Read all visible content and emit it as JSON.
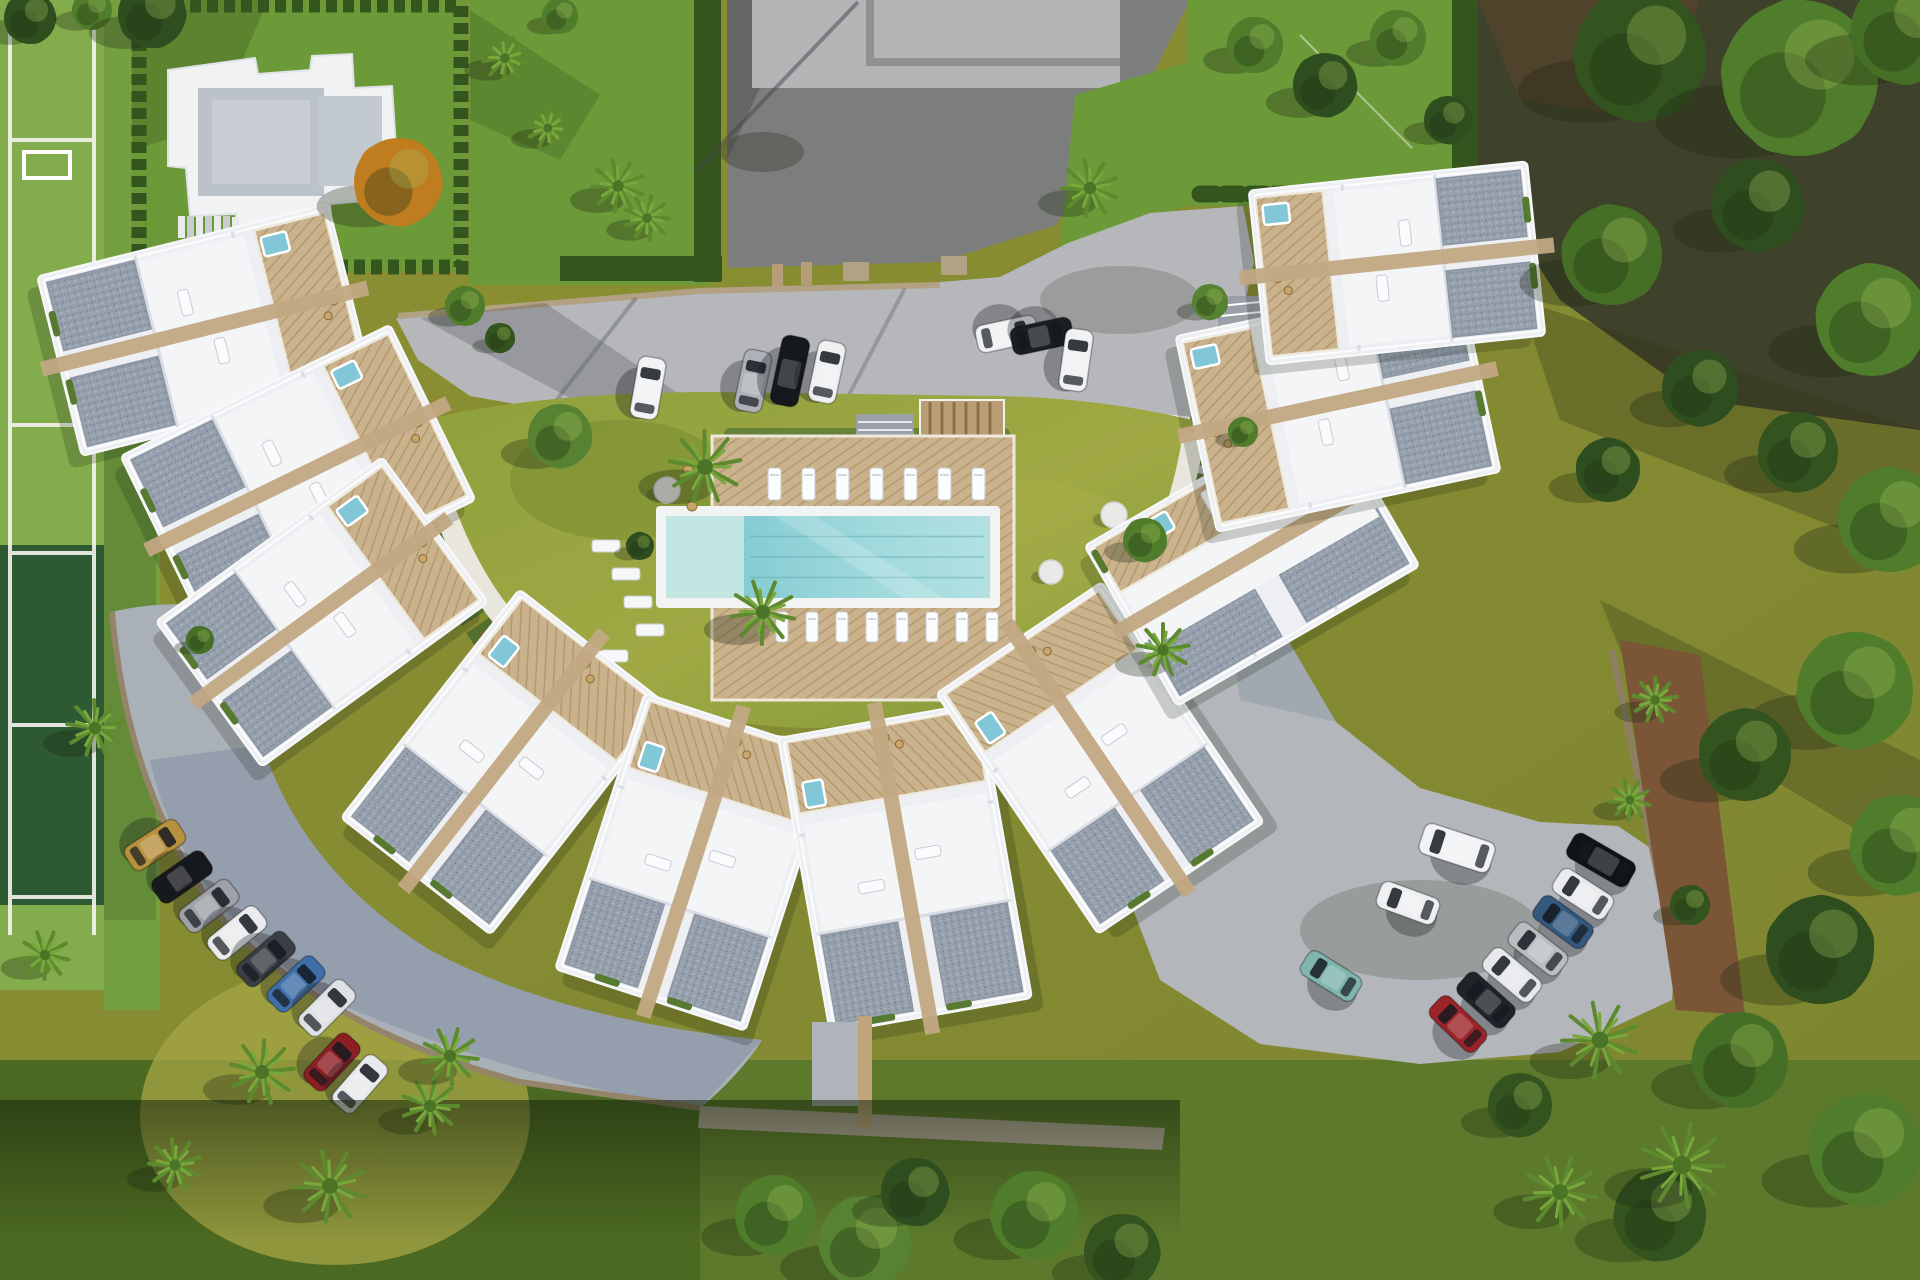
{
  "scene": {
    "title": "Aerial render of crescent-shaped residential complex",
    "description": "Top-down 3D architectural rendering: a horseshoe arc of white townhouses with gray gravel roofs, wooden roof terraces and plunge pools around a central lawn courtyard with a turquoise swimming pool and sun deck; gray access road and two car parks; tennis court on the left, detached villa plot top-left, olive lawns and trees around."
  },
  "palette": {
    "olive_field": "#8d9133",
    "lawn_bright": "#6c9a39",
    "lawn_courtyard": "#97a341",
    "lawn_dark": "#43611f",
    "court_light": "#83ac4c",
    "court_dark": "#2d5a33",
    "hedge": "#34551e",
    "road": "#b6b7bb",
    "dark_lot": "#7c7e7d",
    "parking_shade": "#7e8ea1",
    "building_white": "#edeff2",
    "gravel_roof": "#97a1ae",
    "deck_wood": "#c9b28c",
    "travertine": "#c2a883",
    "pool_main": "#8ed2d6",
    "pool_shallow": "#c3e6e3",
    "forest_floor": "#3f422a",
    "walkway": "#e9e6dd",
    "terracotta": "#9c5a30"
  },
  "pool": {
    "rim": {
      "x": 656,
      "y": 506,
      "w": 344,
      "h": 102
    },
    "shallow": {
      "x": 666,
      "y": 516,
      "w": 78,
      "h": 82
    },
    "main": {
      "x": 744,
      "y": 516,
      "w": 246,
      "h": 82
    },
    "deck": {
      "x": 712,
      "y": 436,
      "w": 302,
      "h": 264
    }
  },
  "lounger_rows": [
    {
      "x0": 768,
      "y": 468,
      "n": 7,
      "dx": 34,
      "w": 13,
      "l": 32
    },
    {
      "x0": 776,
      "y": 612,
      "n": 8,
      "dx": 30,
      "w": 12,
      "l": 30
    }
  ],
  "lawn_mats": [
    {
      "x": 592,
      "y": 540
    },
    {
      "x": 612,
      "y": 568
    },
    {
      "x": 624,
      "y": 596
    },
    {
      "x": 636,
      "y": 624
    },
    {
      "x": 600,
      "y": 650
    }
  ],
  "stepping_stones": [
    {
      "x": 1114,
      "y": 515,
      "r": 13
    },
    {
      "x": 1051,
      "y": 572,
      "r": 12
    },
    {
      "x": 667,
      "y": 490,
      "r": 13
    }
  ],
  "clusters": [
    {
      "name": "nw-upper",
      "cx": 205,
      "cy": 330,
      "rot": -14,
      "w": 300,
      "h": 185,
      "deck": "right"
    },
    {
      "name": "nw-lower",
      "cx": 298,
      "cy": 478,
      "rot": -26,
      "w": 300,
      "h": 195,
      "deck": "right"
    },
    {
      "name": "west",
      "cx": 322,
      "cy": 612,
      "rot": -36,
      "w": 280,
      "h": 180,
      "deck": "right"
    },
    {
      "name": "southwest",
      "cx": 505,
      "cy": 762,
      "rot": -52,
      "w": 290,
      "h": 190,
      "deck": "right"
    },
    {
      "name": "south-1",
      "cx": 695,
      "cy": 862,
      "rot": -72,
      "w": 290,
      "h": 200,
      "deck": "right"
    },
    {
      "name": "south-2",
      "cx": 905,
      "cy": 868,
      "rot": -100,
      "w": 300,
      "h": 205,
      "deck": "right"
    },
    {
      "name": "southeast",
      "cx": 1100,
      "cy": 758,
      "rot": -124,
      "w": 290,
      "h": 200,
      "deck": "right"
    },
    {
      "name": "east",
      "cx": 1252,
      "cy": 556,
      "rot": -30,
      "w": 280,
      "h": 185,
      "deck": "top"
    },
    {
      "name": "northeast-a",
      "cx": 1338,
      "cy": 404,
      "rot": -12,
      "w": 290,
      "h": 200,
      "deck": "left"
    },
    {
      "name": "northeast-b",
      "cx": 1397,
      "cy": 263,
      "rot": -6,
      "w": 280,
      "h": 175,
      "deck": "left"
    }
  ],
  "cars": [
    {
      "x": 648,
      "y": 388,
      "rot": 10,
      "c": "#f2f3f5"
    },
    {
      "x": 753,
      "y": 381,
      "rot": 12,
      "c": "#aeb2b8"
    },
    {
      "x": 790,
      "y": 371,
      "rot": 12,
      "c": "#15181c",
      "len": 70
    },
    {
      "x": 827,
      "y": 372,
      "rot": 12,
      "c": "#eef0f2"
    },
    {
      "x": 1007,
      "y": 334,
      "rot": 78,
      "c": "#f0f1f3"
    },
    {
      "x": 1042,
      "y": 336,
      "rot": 78,
      "c": "#1a1d22"
    },
    {
      "x": 1076,
      "y": 360,
      "rot": 8,
      "c": "#f1f2f4"
    },
    {
      "x": 155,
      "y": 845,
      "rot": 57,
      "c": "#b8913f"
    },
    {
      "x": 182,
      "y": 877,
      "rot": 55,
      "c": "#17191d"
    },
    {
      "x": 209,
      "y": 906,
      "rot": 53,
      "c": "#9ea2a8"
    },
    {
      "x": 237,
      "y": 933,
      "rot": 51,
      "c": "#e9ebee"
    },
    {
      "x": 266,
      "y": 959,
      "rot": 49,
      "c": "#3a3f45"
    },
    {
      "x": 296,
      "y": 984,
      "rot": 47,
      "c": "#3f6fa8"
    },
    {
      "x": 327,
      "y": 1008,
      "rot": 45,
      "c": "#dfe2e5"
    },
    {
      "x": 332,
      "y": 1062,
      "rot": 43,
      "c": "#8c1f24"
    },
    {
      "x": 360,
      "y": 1084,
      "rot": 41,
      "c": "#e8eaed"
    },
    {
      "x": 1457,
      "y": 848,
      "rot": -72,
      "c": "#f2f3f5",
      "len": 74,
      "wd": 32
    },
    {
      "x": 1408,
      "y": 903,
      "rot": -70,
      "c": "#eef0f2"
    },
    {
      "x": 1331,
      "y": 976,
      "rot": -58,
      "c": "#7fb5ad"
    },
    {
      "x": 1601,
      "y": 860,
      "rot": -60,
      "c": "#101317",
      "len": 70
    },
    {
      "x": 1583,
      "y": 894,
      "rot": -57,
      "c": "#e9ebee"
    },
    {
      "x": 1563,
      "y": 922,
      "rot": -54,
      "c": "#33597f"
    },
    {
      "x": 1538,
      "y": 949,
      "rot": -52,
      "c": "#b9bdc2"
    },
    {
      "x": 1512,
      "y": 975,
      "rot": -50,
      "c": "#e6e8eb"
    },
    {
      "x": 1486,
      "y": 1000,
      "rot": -48,
      "c": "#202329"
    },
    {
      "x": 1458,
      "y": 1024,
      "rot": -46,
      "c": "#9c2328"
    }
  ],
  "trees": [
    {
      "t": "round",
      "x": 30,
      "y": 18,
      "r": 26,
      "c": "#2f4e1f"
    },
    {
      "t": "round",
      "x": 92,
      "y": 10,
      "r": 20,
      "c": "#4f7d2b"
    },
    {
      "t": "round",
      "x": 152,
      "y": 14,
      "r": 34,
      "c": "#2f4e1f"
    },
    {
      "t": "round",
      "x": 560,
      "y": 16,
      "r": 18,
      "c": "#4f7d2b"
    },
    {
      "t": "palm",
      "x": 505,
      "y": 58,
      "r": 22
    },
    {
      "t": "palm",
      "x": 548,
      "y": 128,
      "r": 20
    },
    {
      "t": "palm",
      "x": 618,
      "y": 186,
      "r": 26
    },
    {
      "t": "palm",
      "x": 647,
      "y": 218,
      "r": 22
    },
    {
      "t": "round",
      "x": 398,
      "y": 182,
      "r": 44,
      "c": "#bf7d20"
    },
    {
      "t": "round",
      "x": 1255,
      "y": 45,
      "r": 28,
      "c": "#4f7d2b"
    },
    {
      "t": "round",
      "x": 1325,
      "y": 85,
      "r": 32,
      "c": "#2f4e1f"
    },
    {
      "t": "round",
      "x": 1398,
      "y": 38,
      "r": 28,
      "c": "#4f7d2b"
    },
    {
      "t": "round",
      "x": 1448,
      "y": 120,
      "r": 24,
      "c": "#2f4e1f"
    },
    {
      "t": "palm",
      "x": 1090,
      "y": 188,
      "r": 28
    },
    {
      "t": "round",
      "x": 1640,
      "y": 55,
      "r": 66,
      "c": "#33531f"
    },
    {
      "t": "round",
      "x": 1800,
      "y": 78,
      "r": 78,
      "c": "#4f7d2b"
    },
    {
      "t": "round",
      "x": 1905,
      "y": 30,
      "r": 54,
      "c": "#456f26"
    },
    {
      "t": "round",
      "x": 1612,
      "y": 255,
      "r": 50,
      "c": "#456f26"
    },
    {
      "t": "round",
      "x": 1758,
      "y": 205,
      "r": 46,
      "c": "#2f4e1f"
    },
    {
      "t": "round",
      "x": 1872,
      "y": 320,
      "r": 56,
      "c": "#4f7d2b"
    },
    {
      "t": "round",
      "x": 1700,
      "y": 388,
      "r": 38,
      "c": "#2f4e1f"
    },
    {
      "t": "round",
      "x": 1890,
      "y": 520,
      "r": 52,
      "c": "#4f7d2b"
    },
    {
      "t": "round",
      "x": 1798,
      "y": 452,
      "r": 40,
      "c": "#33531f"
    },
    {
      "t": "round",
      "x": 1608,
      "y": 470,
      "r": 32,
      "c": "#2f4e1f"
    },
    {
      "t": "round",
      "x": 1855,
      "y": 690,
      "r": 58,
      "c": "#4f7d2b"
    },
    {
      "t": "round",
      "x": 1745,
      "y": 755,
      "r": 46,
      "c": "#33531f"
    },
    {
      "t": "round",
      "x": 1900,
      "y": 845,
      "r": 50,
      "c": "#4f7d2b"
    },
    {
      "t": "round",
      "x": 1820,
      "y": 950,
      "r": 54,
      "c": "#2f4e1f"
    },
    {
      "t": "round",
      "x": 1740,
      "y": 1060,
      "r": 48,
      "c": "#456f26"
    },
    {
      "t": "round",
      "x": 1865,
      "y": 1150,
      "r": 56,
      "c": "#4f7d2b"
    },
    {
      "t": "round",
      "x": 1660,
      "y": 1215,
      "r": 46,
      "c": "#33531f"
    },
    {
      "t": "round",
      "x": 775,
      "y": 1215,
      "r": 40,
      "c": "#4f7d2b"
    },
    {
      "t": "round",
      "x": 865,
      "y": 1242,
      "r": 46,
      "c": "#568231"
    },
    {
      "t": "round",
      "x": 915,
      "y": 1192,
      "r": 34,
      "c": "#2f4e1f"
    },
    {
      "t": "round",
      "x": 1035,
      "y": 1215,
      "r": 44,
      "c": "#4f7d2b"
    },
    {
      "t": "round",
      "x": 1122,
      "y": 1252,
      "r": 38,
      "c": "#33531f"
    },
    {
      "t": "palm",
      "x": 95,
      "y": 728,
      "r": 28
    },
    {
      "t": "palm",
      "x": 45,
      "y": 955,
      "r": 24
    },
    {
      "t": "palm",
      "x": 262,
      "y": 1072,
      "r": 32
    },
    {
      "t": "palm",
      "x": 330,
      "y": 1186,
      "r": 36
    },
    {
      "t": "palm",
      "x": 430,
      "y": 1106,
      "r": 28
    },
    {
      "t": "palm",
      "x": 175,
      "y": 1165,
      "r": 26
    },
    {
      "t": "palm",
      "x": 450,
      "y": 1056,
      "r": 28
    },
    {
      "t": "palm",
      "x": 705,
      "y": 467,
      "r": 36
    },
    {
      "t": "palm",
      "x": 763,
      "y": 612,
      "r": 32
    },
    {
      "t": "round",
      "x": 560,
      "y": 436,
      "r": 32,
      "c": "#568231"
    },
    {
      "t": "round",
      "x": 465,
      "y": 306,
      "r": 20,
      "c": "#4f7d2b"
    },
    {
      "t": "round",
      "x": 500,
      "y": 338,
      "r": 15,
      "c": "#33531f"
    },
    {
      "t": "round",
      "x": 640,
      "y": 546,
      "r": 14,
      "c": "#2f4e1f"
    },
    {
      "t": "round",
      "x": 1145,
      "y": 540,
      "r": 22,
      "c": "#4f7d2b"
    },
    {
      "t": "palm",
      "x": 1163,
      "y": 650,
      "r": 26
    },
    {
      "t": "round",
      "x": 1210,
      "y": 302,
      "r": 18,
      "c": "#568231"
    },
    {
      "t": "round",
      "x": 1243,
      "y": 432,
      "r": 15,
      "c": "#4f7d2b"
    },
    {
      "t": "palm",
      "x": 1600,
      "y": 1040,
      "r": 38
    },
    {
      "t": "palm",
      "x": 1682,
      "y": 1165,
      "r": 42
    },
    {
      "t": "round",
      "x": 1520,
      "y": 1105,
      "r": 32,
      "c": "#33531f"
    },
    {
      "t": "palm",
      "x": 1560,
      "y": 1192,
      "r": 36
    },
    {
      "t": "palm",
      "x": 1655,
      "y": 700,
      "r": 22
    },
    {
      "t": "palm",
      "x": 1630,
      "y": 800,
      "r": 20
    },
    {
      "t": "round",
      "x": 200,
      "y": 640,
      "r": 14,
      "c": "#456f26"
    },
    {
      "t": "round",
      "x": 1690,
      "y": 905,
      "r": 20,
      "c": "#33531f"
    }
  ]
}
